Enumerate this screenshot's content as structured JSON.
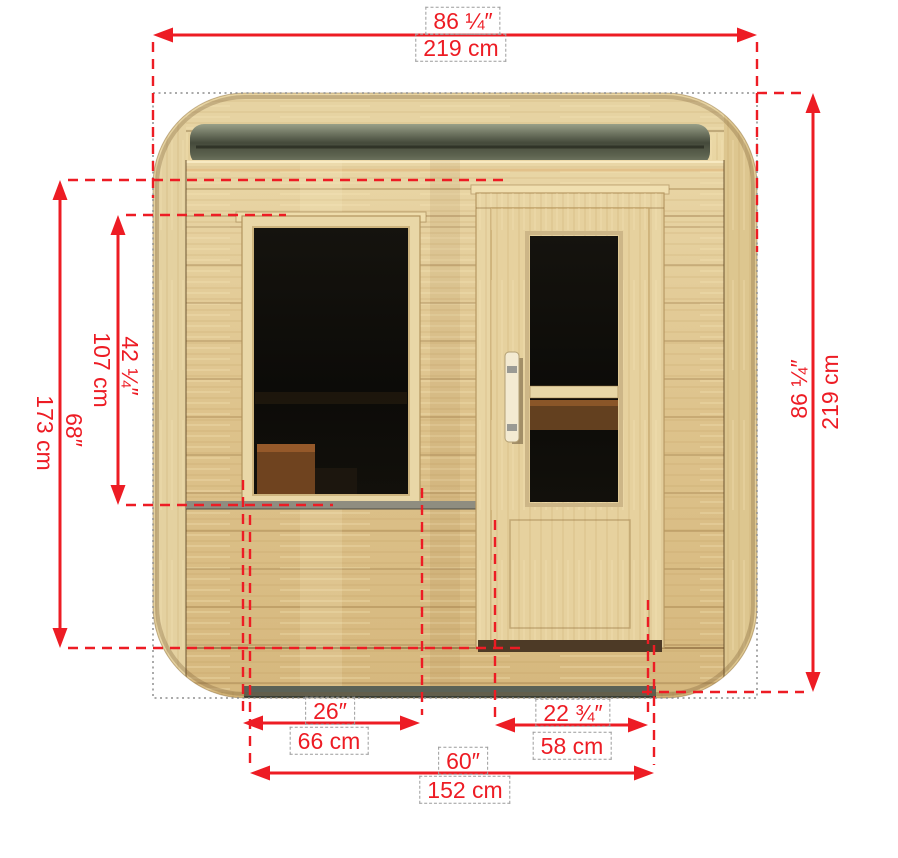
{
  "diagram": {
    "subject": "sauna-front-elevation-dimension-diagram",
    "colors": {
      "dimension_red": "#ed1c24",
      "guide_gray": "#8e8e8e",
      "wood_light": "#e7d4a4",
      "wood_mid": "#d9bd85",
      "recess_dark": "#494e3f",
      "glass_dark": "#100f0b"
    },
    "dimensions": {
      "overall_width": {
        "inches": "86 ¼″",
        "cm": "219 cm"
      },
      "overall_height": {
        "inches": "86 ¼″",
        "cm": "219 cm"
      },
      "wall_height": {
        "inches": "68″",
        "cm": "173 cm"
      },
      "window_height": {
        "inches": "42 ¼″",
        "cm": "107 cm"
      },
      "window_width": {
        "inches": "26″",
        "cm": "66 cm"
      },
      "door_width": {
        "inches": "22 ¾″",
        "cm": "58 cm"
      },
      "span_width": {
        "inches": "60″",
        "cm": "152 cm"
      }
    }
  }
}
